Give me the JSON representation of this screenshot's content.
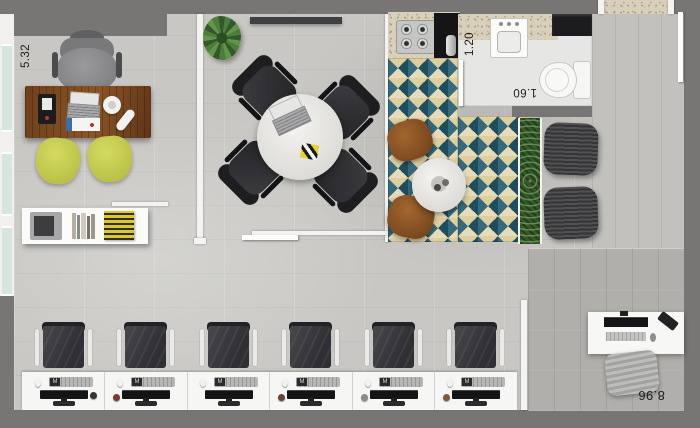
{
  "dimensions": {
    "office": "5.32",
    "bathroom_width": "1.20",
    "bathroom_length": "1.60",
    "open_space": "8.96"
  },
  "workstations": {
    "count": 6,
    "keyboard_badge": "M"
  },
  "colors": {
    "surround_gray": "#787674",
    "floor_light": "#c8c7c3",
    "floor_dark": "#b1afab",
    "tile_teal_dark": "#1e4d5d",
    "tile_teal_mid": "#35697c",
    "tile_cream": "#e7dcba",
    "guest_chair_yellow": "#c9d04f",
    "hedge_green": "#36582b",
    "desk_wood": "#7a4a22"
  }
}
